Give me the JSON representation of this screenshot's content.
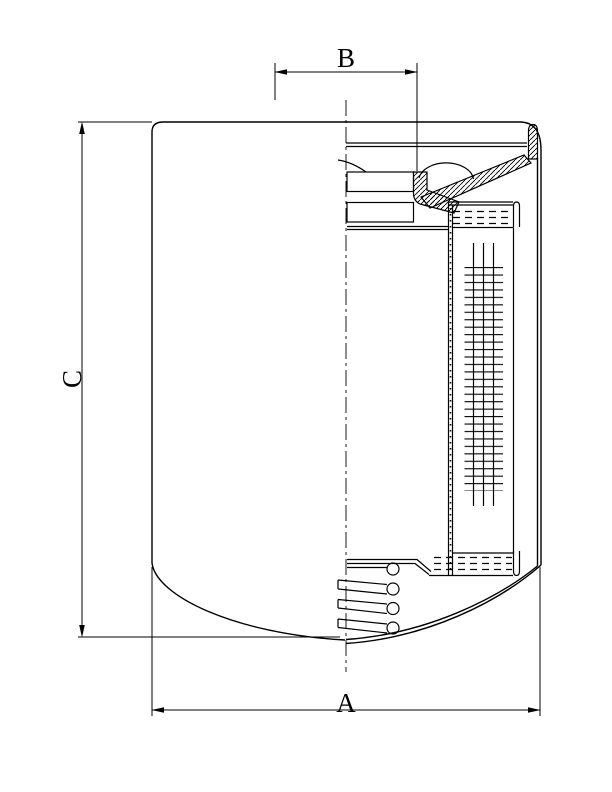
{
  "page": {
    "description": "Technical cross-section drawing of a spin-on filter cartridge with dimension callouts",
    "background_color": "#ffffff",
    "line_color": "#000000"
  },
  "dimensions": {
    "a": {
      "label": "A",
      "axis": "horizontal",
      "position": "bottom",
      "measures": "outer diameter"
    },
    "b": {
      "label": "B",
      "axis": "horizontal",
      "position": "top",
      "measures": "thread diameter"
    },
    "c": {
      "label": "C",
      "axis": "vertical",
      "position": "left",
      "measures": "overall height"
    }
  }
}
